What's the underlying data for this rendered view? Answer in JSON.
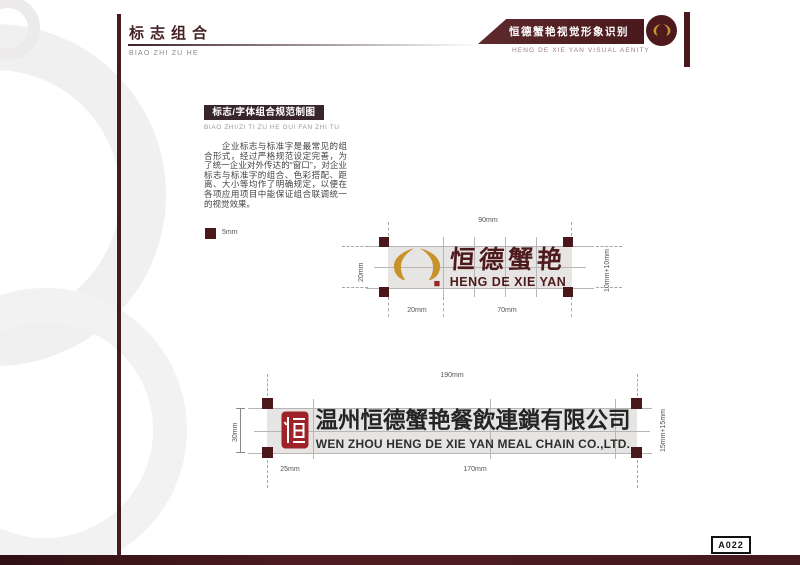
{
  "header": {
    "title": "标志组合",
    "pinyin": "BIAO ZHI ZU HE",
    "banner": {
      "title": "恒德蟹艳视觉形象识别",
      "subtitle": "HENG DE XIE YAN VISUAL AENITY"
    }
  },
  "section": {
    "title": "标志/字体组合规范制图",
    "pinyin": "BIAO ZHI/ZI TI ZU HE GUI FAN ZHI TU",
    "body": "　　企业标志与标准字是最常见的组合形式，经过严格规范设定完善，为了统一企业对外传达的“窗口”，对企业标志与标准字的组合、色彩搭配、距离、大小等均作了明确规定，以便在各项应用项目中能保证组合联调统一的视觉效果。",
    "legend": "5mm"
  },
  "diagram_small": {
    "dim_top": "90mm",
    "dim_left": "20mm",
    "dim_right": "10mm+10mm",
    "dim_bottom_left": "20mm",
    "dim_bottom_right": "70mm",
    "logo_cn": "恒德蟹艳",
    "logo_en": "HENG DE XIE YAN"
  },
  "diagram_large": {
    "dim_top": "190mm",
    "dim_left": "30mm",
    "dim_right": "15mm+15mm",
    "dim_bottom_left": "25mm",
    "dim_bottom_right": "170mm",
    "logo_cn": "温州恒德蟹艳餐飲連鎖有限公司",
    "logo_en": "WEN ZHOU HENG DE XIE YAN MEAL CHAIN CO.,LTD."
  },
  "footer": {
    "page_code": "A022"
  },
  "colors": {
    "maroon": "#4a191c",
    "gold": "#c8922a",
    "seal_red": "#9e2328",
    "band_gray": "#e6e5e3"
  }
}
